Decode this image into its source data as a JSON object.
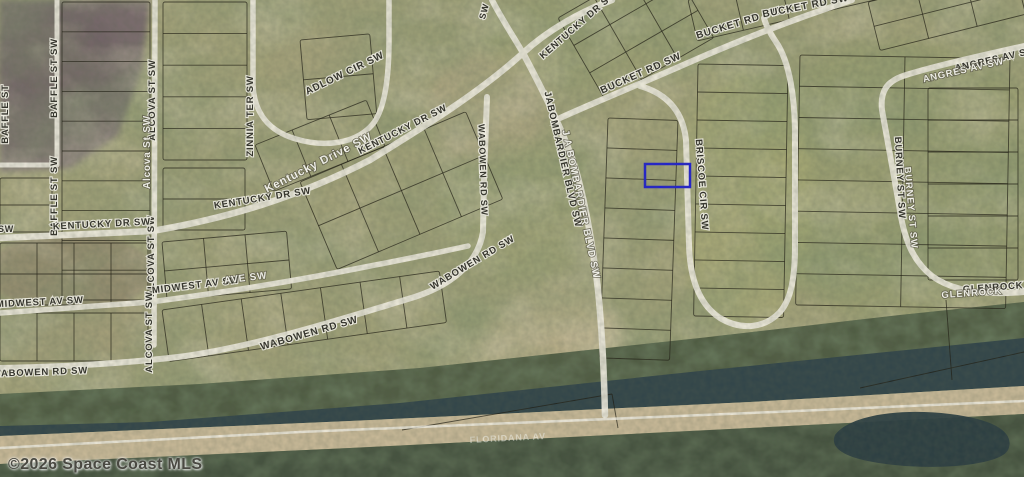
{
  "map": {
    "copyright": "©2026 Space Coast MLS",
    "colors": {
      "base": "#a2a179",
      "road": "#edeadd",
      "parcel_line": "rgba(30,28,18,0.72)",
      "trees": "#4a573f",
      "water": "#33464a",
      "bank": "#c7b897",
      "marsh": "#45523f",
      "pond": "#2c3e42",
      "highlight": "#2222cf"
    },
    "highlight": {
      "name": "subject-parcel",
      "x": 645,
      "y": 164,
      "w": 45,
      "h": 23
    },
    "labels": [
      {
        "t": "BAFFLE ST SW",
        "x": 57,
        "y": 78,
        "r": -90,
        "k": "dark",
        "s": 9.5
      },
      {
        "t": "BAFFLE ST SW",
        "x": 57,
        "y": 196,
        "r": -90,
        "k": "dark",
        "s": 9.5
      },
      {
        "t": "BAFFLE ST",
        "x": 8,
        "y": 114,
        "r": -90,
        "k": "dark",
        "s": 9.5
      },
      {
        "t": "ALCOVA ST SW",
        "x": 155,
        "y": 100,
        "r": -90,
        "k": "dark",
        "s": 9.5
      },
      {
        "t": "Alcova St SW",
        "x": 150,
        "y": 152,
        "r": -90,
        "k": "light",
        "s": 10
      },
      {
        "t": "ALCOVA ST SW",
        "x": 154,
        "y": 256,
        "r": -90,
        "k": "dark",
        "s": 9.5
      },
      {
        "t": "ALCOVA ST SW",
        "x": 152,
        "y": 332,
        "r": -90,
        "k": "dark",
        "s": 9.5
      },
      {
        "t": "ZINNIA TER SW",
        "x": 253,
        "y": 116,
        "r": -90,
        "k": "dark",
        "s": 9.5
      },
      {
        "t": "ADLOW CIR SW",
        "x": 346,
        "y": 76,
        "r": -26,
        "k": "dark",
        "s": 10
      },
      {
        "t": "SW",
        "x": 6,
        "y": 232,
        "r": 0,
        "k": "dark",
        "s": 9
      },
      {
        "t": "KENTUCKY DR SW",
        "x": 102,
        "y": 227,
        "r": -3,
        "k": "dark",
        "s": 9.5
      },
      {
        "t": "KENTUCKY DR SW",
        "x": 263,
        "y": 201,
        "r": -9,
        "k": "dark",
        "s": 9.5
      },
      {
        "t": "Kentucky Drive SW",
        "x": 320,
        "y": 166,
        "r": -27,
        "k": "light",
        "s": 11.5
      },
      {
        "t": "KENTUCKY DR SW",
        "x": 404,
        "y": 132,
        "r": -27,
        "k": "dark",
        "s": 9.5
      },
      {
        "t": "KENTUCKY DR SW",
        "x": 580,
        "y": 27,
        "r": -41,
        "k": "dark",
        "s": 9.5
      },
      {
        "t": "SW",
        "x": 487,
        "y": 12,
        "r": -75,
        "k": "dark",
        "s": 9
      },
      {
        "t": "MIDWEST AV SW",
        "x": 40,
        "y": 305,
        "r": -3,
        "k": "dark",
        "s": 9.5
      },
      {
        "t": "MIDWEST AV SW",
        "x": 196,
        "y": 288,
        "r": -7,
        "k": "dark",
        "s": 9.5
      },
      {
        "t": "AVE SW",
        "x": 246,
        "y": 281,
        "r": -7,
        "k": "light",
        "s": 10
      },
      {
        "t": "WABOWEN RD SW",
        "x": 40,
        "y": 375,
        "r": -2,
        "k": "dark",
        "s": 9.5
      },
      {
        "t": "WABOWEN RD SW",
        "x": 310,
        "y": 336,
        "r": -16,
        "k": "dark",
        "s": 10
      },
      {
        "t": "WABOWEN RD SW",
        "x": 474,
        "y": 265,
        "r": -31,
        "k": "dark",
        "s": 9.5
      },
      {
        "t": "WABOWEN RD SW",
        "x": 480,
        "y": 170,
        "r": 88,
        "k": "dark",
        "s": 9
      },
      {
        "t": "JABOMBARDIER BLVD SW",
        "x": 560,
        "y": 160,
        "r": 77,
        "k": "dark",
        "s": 9.5
      },
      {
        "t": "J A BOMBARDIER BLVD SW",
        "x": 578,
        "y": 205,
        "r": 78,
        "k": "light",
        "s": 10
      },
      {
        "t": "BUCKET RD SW",
        "x": 642,
        "y": 76,
        "r": -24,
        "k": "dark",
        "s": 10
      },
      {
        "t": "BUCKET RD SW",
        "x": 739,
        "y": 26,
        "r": -17,
        "k": "dark",
        "s": 10
      },
      {
        "t": "BUCKET RD SW",
        "x": 806,
        "y": 9,
        "r": -11,
        "k": "dark",
        "s": 10
      },
      {
        "t": "BRISCOE CIR SW",
        "x": 699,
        "y": 185,
        "r": 86,
        "k": "dark",
        "s": 9.5
      },
      {
        "t": "ANGRES AV SW",
        "x": 996,
        "y": 62,
        "r": -13,
        "k": "dark",
        "s": 9.5
      },
      {
        "t": "ANGRES AV SW",
        "x": 964,
        "y": 73,
        "r": -13,
        "k": "light",
        "s": 9.5
      },
      {
        "t": "BURNEY ST SW",
        "x": 897,
        "y": 178,
        "r": 87,
        "k": "dark",
        "s": 9.5
      },
      {
        "t": "BURNEY ST SW",
        "x": 908,
        "y": 208,
        "r": 85,
        "k": "light",
        "s": 9.5
      },
      {
        "t": "GLENROCK AV SW",
        "x": 1012,
        "y": 289,
        "r": -4,
        "k": "dark",
        "s": 9.5
      },
      {
        "t": "GLENROCK",
        "x": 972,
        "y": 296,
        "r": -4,
        "k": "light",
        "s": 9.5
      },
      {
        "t": "FLORIDANA AV",
        "x": 508,
        "y": 441,
        "r": -3,
        "k": "faint",
        "s": 9
      }
    ],
    "roads": [
      {
        "n": "kentucky-dr-sw",
        "d": "M 0,238 L 152,231 C 230,218 300,196 370,160 C 430,123 480,92 523,53 C 548,30 580,12 612,0",
        "w": 6.5
      },
      {
        "n": "kentucky-dr-sw-north",
        "d": "M 523,53 C 513,36 500,16 492,0",
        "w": 6
      },
      {
        "n": "j-a-bombardier-blvd-sw",
        "d": "M 523,53 C 540,85 558,120 572,158 C 583,190 592,240 598,290 C 602,330 604,370 605,415",
        "w": 6.5
      },
      {
        "n": "bucket-rd-sw",
        "d": "M 560,118 C 600,100 640,84 690,62 C 745,38 800,17 852,0",
        "w": 6
      },
      {
        "n": "briscoe-cir-sw",
        "d": "M 640,86 C 668,94 683,112 686,140 L 689,245 C 690,280 700,305 720,318 C 742,331 765,328 780,312 C 792,298 795,275 795,245 L 795,135 C 795,100 790,62 776,42 C 770,33 766,26 764,18",
        "w": 6
      },
      {
        "n": "wabowen-rd-sw",
        "d": "M 487,97 L 484,180 L 483,232 C 478,264 450,287 408,299 C 345,318 255,347 178,357 C 118,364 58,367 0,368",
        "w": 6
      },
      {
        "n": "midwest-av-sw",
        "d": "M 0,313 L 150,302 C 235,291 310,278 365,267 C 412,258 445,251 468,246",
        "w": 5.5
      },
      {
        "n": "alcova-st-sw",
        "d": "M 155,0 L 154,345",
        "w": 5.5
      },
      {
        "n": "baffle-st-sw",
        "d": "M 57,0 L 57,164",
        "w": 5
      },
      {
        "n": "west-av-stub",
        "d": "M 0,165 L 57,165",
        "w": 5
      },
      {
        "n": "adlow-cir-sw",
        "d": "M 253,0 L 253,85 C 254,112 268,131 296,139 C 326,148 356,143 372,125 C 385,110 389,78 389,40 L 389,0",
        "w": 5.5
      },
      {
        "n": "angres-burney-glenrock",
        "d": "M 1024,46 C 975,57 935,66 906,75 C 886,81 880,92 882,110 L 891,160 L 899,205 C 904,240 913,261 932,276 C 955,293 990,295 1024,292",
        "w": 6
      },
      {
        "n": "canal-track",
        "d": "M 0,448 L 300,432 L 750,413 L 1024,401",
        "w": 2.5,
        "c": "rgba(242,240,230,0.85)"
      }
    ],
    "blocks": [
      {
        "x": 62,
        "y": 2,
        "w": 88,
        "h": 298,
        "rows": 10,
        "cols": 1,
        "rot": 0
      },
      {
        "x": 163,
        "y": 2,
        "w": 84,
        "h": 158,
        "rows": 5,
        "cols": 1,
        "rot": 0
      },
      {
        "x": 163,
        "y": 168,
        "w": 82,
        "h": 62,
        "rows": 2,
        "cols": 1,
        "rot": 0
      },
      {
        "x": 0,
        "y": 178,
        "w": 52,
        "h": 54,
        "rows": 2,
        "cols": 1,
        "rot": 0
      },
      {
        "x": 0,
        "y": 243,
        "w": 148,
        "h": 62,
        "rows": 2,
        "cols": 4,
        "rot": 0
      },
      {
        "x": 0,
        "y": 313,
        "w": 148,
        "h": 48,
        "rows": 1,
        "cols": 4,
        "rot": 0
      },
      {
        "x": 162,
        "y": 242,
        "w": 125,
        "h": 58,
        "rows": 2,
        "cols": 3,
        "rot": -5
      },
      {
        "x": 162,
        "y": 310,
        "w": 280,
        "h": 52,
        "rows": 1,
        "cols": 7,
        "rot": -8
      },
      {
        "x": 300,
        "y": 182,
        "w": 180,
        "h": 95,
        "rows": 2,
        "cols": 4,
        "rot": -23
      },
      {
        "x": 255,
        "y": 145,
        "w": 120,
        "h": 50,
        "rows": 1,
        "cols": 3,
        "rot": -22
      },
      {
        "x": 300,
        "y": 40,
        "w": 70,
        "h": 80,
        "rows": 2,
        "cols": 1,
        "rot": -5
      },
      {
        "x": 558,
        "y": 18,
        "w": 125,
        "h": 95,
        "rows": 3,
        "cols": 3,
        "rot": -30
      },
      {
        "x": 688,
        "y": 0,
        "w": 330,
        "h": 42,
        "rows": 1,
        "cols": 7,
        "rot": -13
      },
      {
        "x": 608,
        "y": 118,
        "w": 70,
        "h": 240,
        "rows": 8,
        "cols": 1,
        "rot": 2
      },
      {
        "x": 698,
        "y": 64,
        "w": 90,
        "h": 252,
        "rows": 9,
        "cols": 1,
        "rot": 1
      },
      {
        "x": 800,
        "y": 55,
        "w": 210,
        "h": 250,
        "rows": 8,
        "cols": 2,
        "rot": 1
      },
      {
        "x": 928,
        "y": 88,
        "w": 90,
        "h": 192,
        "rows": 6,
        "cols": 1,
        "rot": 0
      },
      {
        "x": 868,
        "y": 2,
        "w": 150,
        "h": 50,
        "rows": 2,
        "cols": 3,
        "rot": -14
      }
    ],
    "lines": [
      {
        "x1": 402,
        "y1": 430,
        "x2": 612,
        "y2": 394
      },
      {
        "x1": 612,
        "y1": 394,
        "x2": 618,
        "y2": 428
      },
      {
        "x1": 946,
        "y1": 300,
        "x2": 952,
        "y2": 380
      },
      {
        "x1": 860,
        "y1": 388,
        "x2": 1024,
        "y2": 352
      }
    ],
    "patches": [
      {
        "type": "polygon",
        "pts": "0,0 150,0 142,70 118,135 70,168 0,172",
        "fill": "#786a6d",
        "op": 0.95,
        "blur": "sm"
      },
      {
        "type": "ellipse",
        "cx": 55,
        "cy": 60,
        "rx": 60,
        "ry": 55,
        "fill": "#6d5d64",
        "op": 0.6,
        "blur": "lg"
      },
      {
        "type": "ellipse",
        "cx": 488,
        "cy": 108,
        "rx": 58,
        "ry": 55,
        "fill": "#b5a986",
        "op": 0.75,
        "blur": "lg"
      },
      {
        "type": "ellipse",
        "cx": 553,
        "cy": 338,
        "rx": 68,
        "ry": 52,
        "fill": "#bfb28d",
        "op": 0.8,
        "blur": "lg"
      },
      {
        "type": "ellipse",
        "cx": 332,
        "cy": 72,
        "rx": 62,
        "ry": 48,
        "fill": "#b0a67f",
        "op": 0.5,
        "blur": "lg"
      },
      {
        "type": "ellipse",
        "cx": 900,
        "cy": 180,
        "rx": 160,
        "ry": 140,
        "fill": "#8e9a66",
        "op": 0.35,
        "blur": "lg"
      },
      {
        "type": "ellipse",
        "cx": 745,
        "cy": 200,
        "rx": 70,
        "ry": 130,
        "fill": "#b3b377",
        "op": 0.4,
        "blur": "lg"
      },
      {
        "type": "ellipse",
        "cx": 80,
        "cy": 330,
        "rx": 90,
        "ry": 40,
        "fill": "#a89f7b",
        "op": 0.5,
        "blur": "lg"
      },
      {
        "type": "ellipse",
        "cx": 70,
        "cy": 272,
        "rx": 85,
        "ry": 38,
        "fill": "#8a7466",
        "op": 0.45,
        "blur": "sm"
      },
      {
        "type": "ellipse",
        "cx": 600,
        "cy": 40,
        "rx": 120,
        "ry": 50,
        "fill": "#9aa070",
        "op": 0.4,
        "blur": "lg"
      },
      {
        "type": "ellipse",
        "cx": 520,
        "cy": 210,
        "rx": 80,
        "ry": 70,
        "fill": "#99a172",
        "op": 0.4,
        "blur": "lg"
      }
    ],
    "bands": {
      "trees": "M 0,394 L 200,384 L 420,368 L 700,338 L 900,315 L 1024,302 L 1024,340 L 700,372 L 400,404 L 150,424 L 0,430 Z",
      "water": "M 0,426 L 150,422 L 400,403 L 700,371 L 1024,338 L 1024,386 L 750,402 L 350,421 L 0,436 Z",
      "bank": "M 0,436 L 350,421 L 750,402 L 1024,386 L 1024,414 L 750,428 L 350,448 L 0,464 Z",
      "marsh": "M 0,464 L 350,448 L 750,428 L 1024,414 L 1024,477 L 0,477 Z",
      "pond": "M 835,435 C 850,415 900,408 950,414 C 1000,420 1015,435 1008,450 C 1000,465 940,470 895,465 C 855,461 828,452 835,435 Z"
    }
  }
}
